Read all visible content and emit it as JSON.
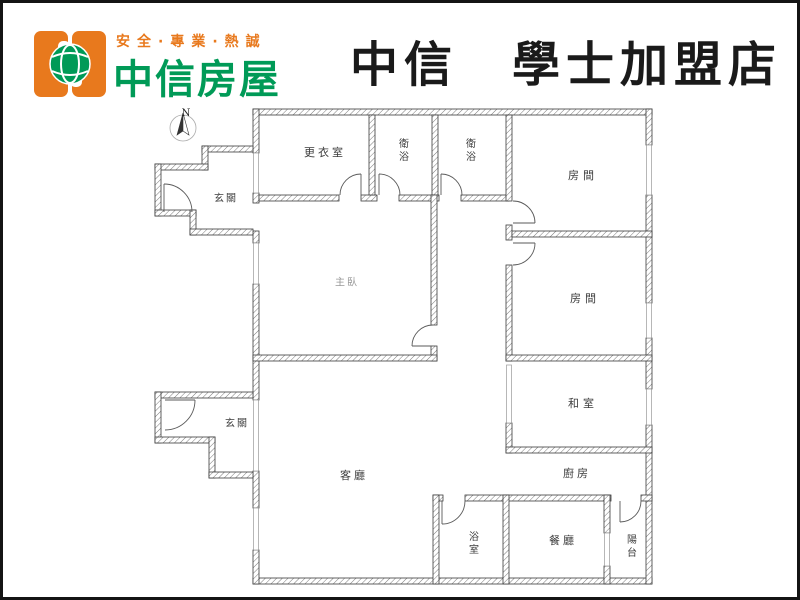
{
  "header": {
    "tagline": "安全·專業·熱誠",
    "brand": "中信房屋",
    "store_title": "中信　學士加盟店",
    "brand_color": "#009a57",
    "accent_color": "#e8791d"
  },
  "compass": {
    "label": "N"
  },
  "rooms": {
    "foyer_top": "玄關",
    "foyer_bottom": "玄關",
    "dressing": "更衣室",
    "bath_top_1": "衛浴",
    "bath_top_2": "衛浴",
    "bedroom_1": "房間",
    "bedroom_2": "房間",
    "master_bedroom": "主臥",
    "tatami": "和室",
    "living": "客廳",
    "kitchen": "廚房",
    "bathroom": "浴室",
    "dining": "餐廳",
    "balcony": "陽台"
  }
}
